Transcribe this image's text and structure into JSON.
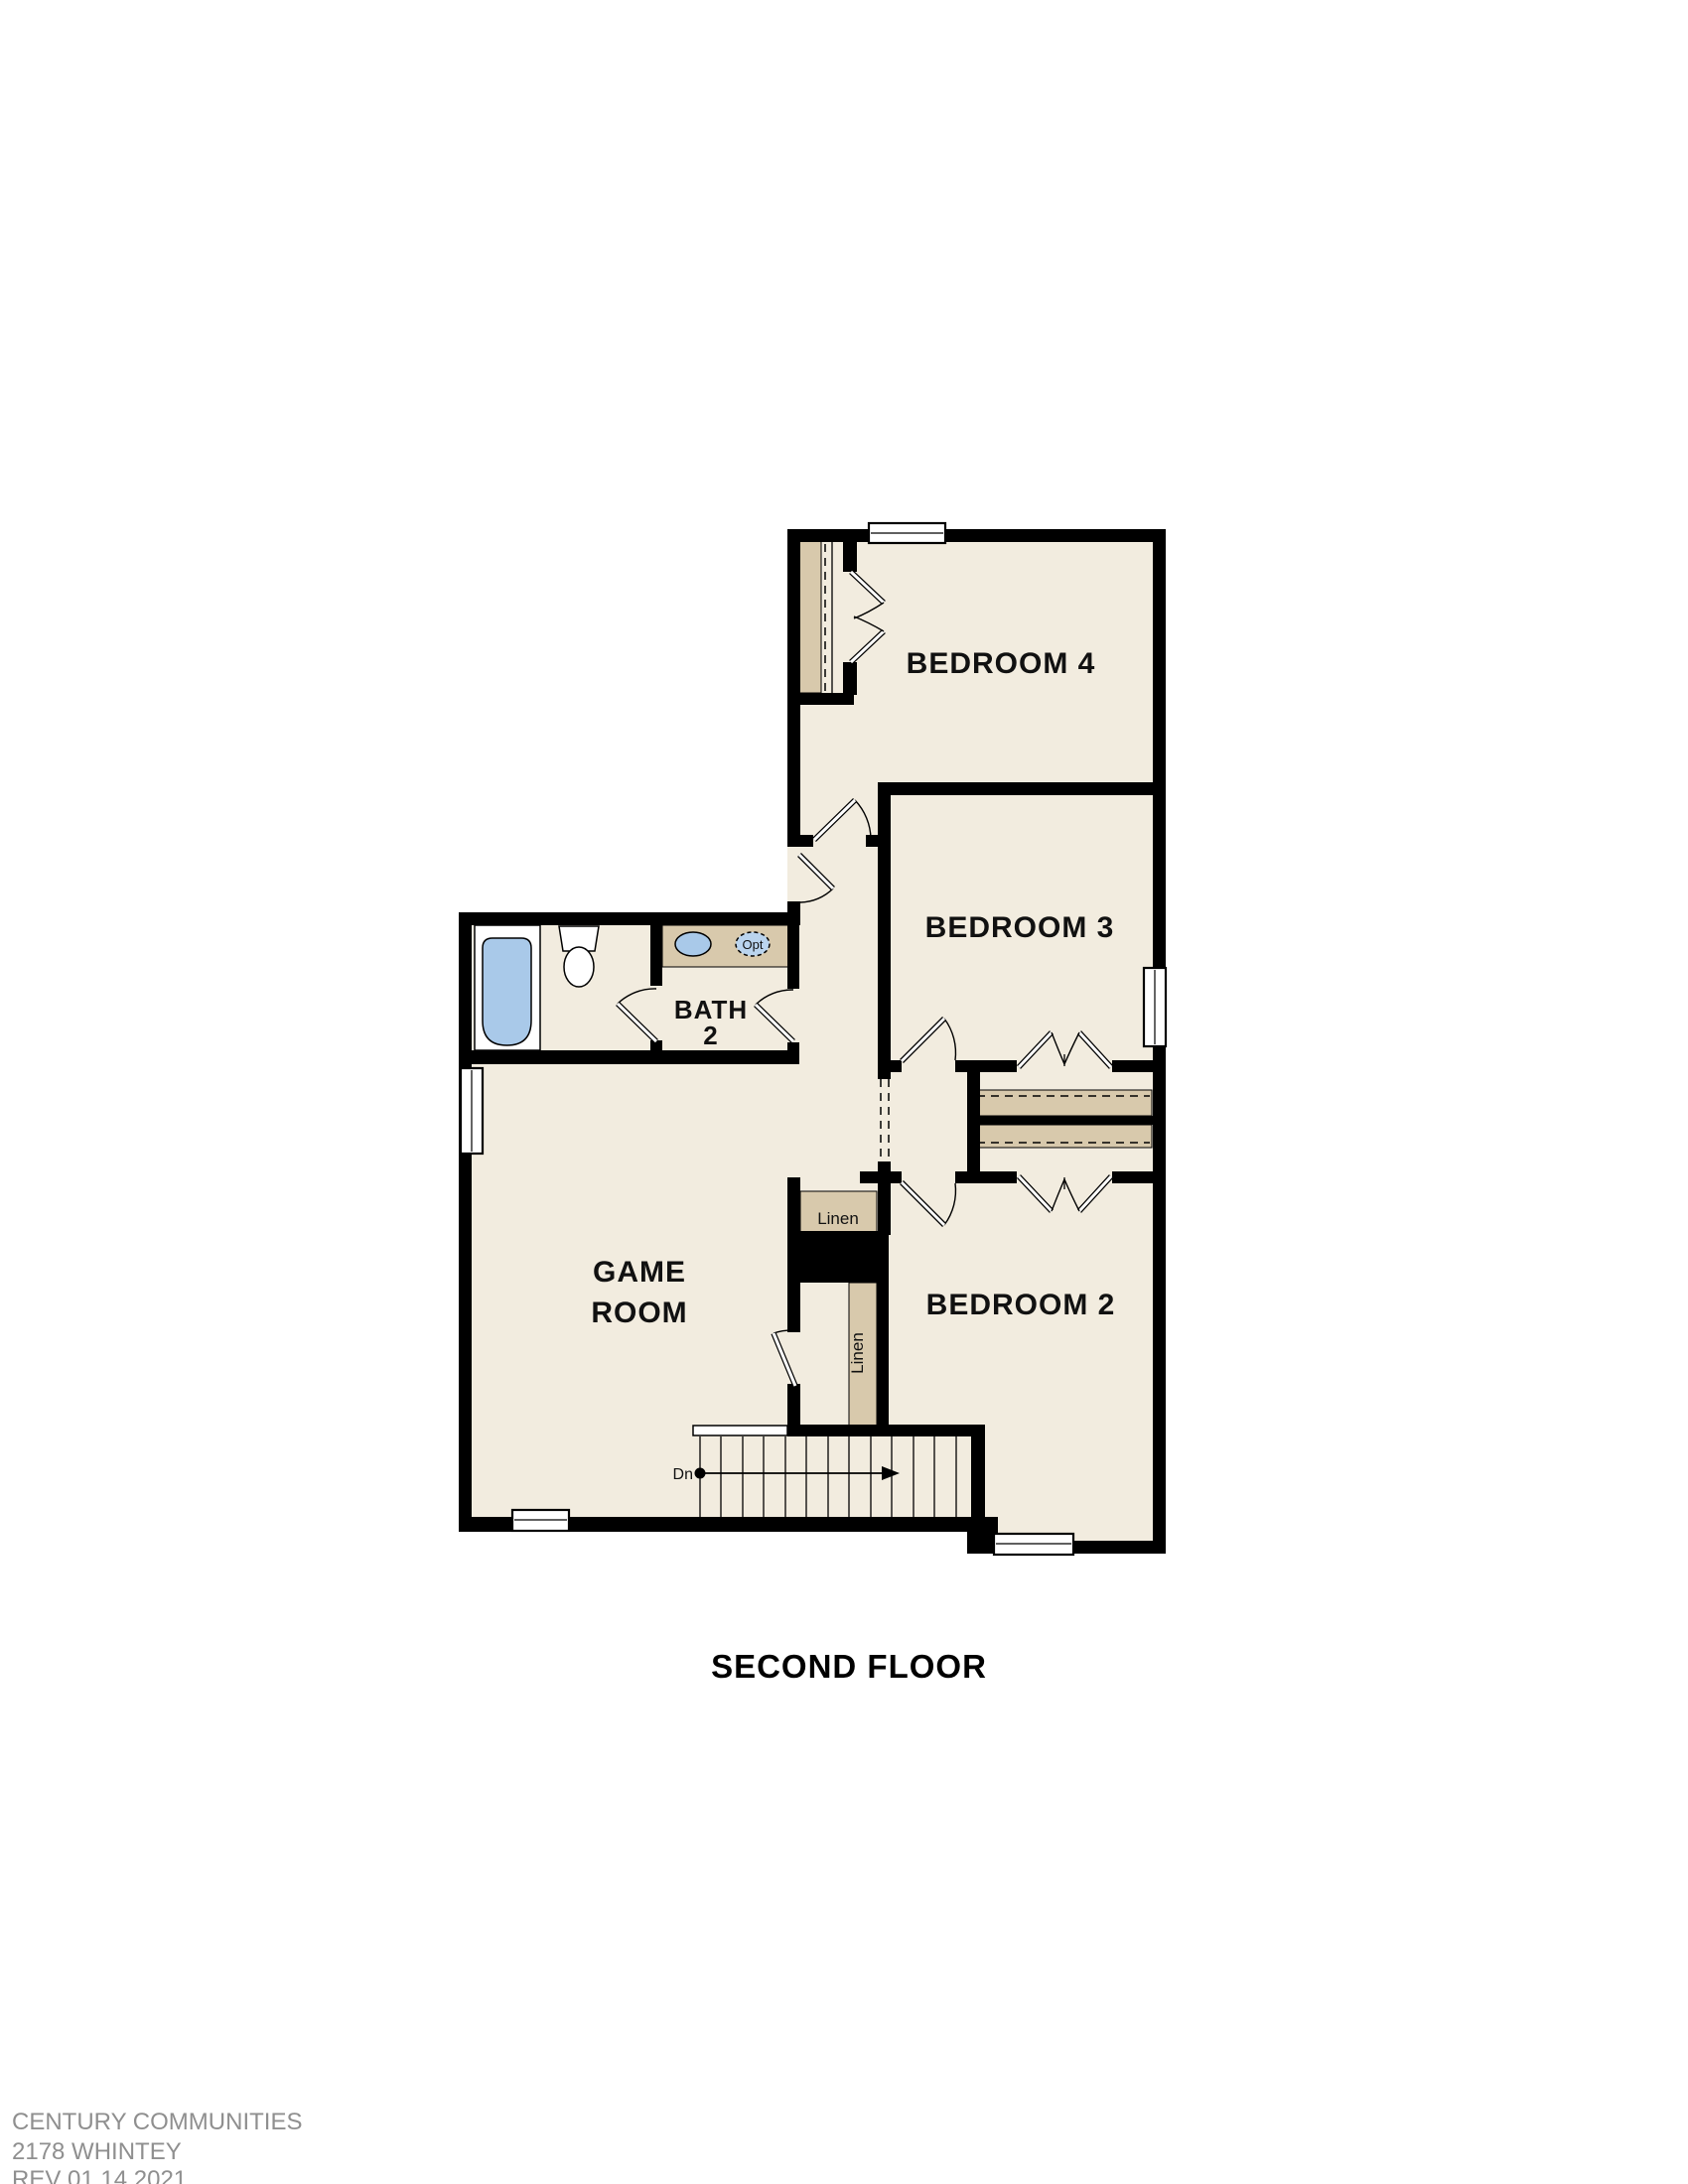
{
  "page": {
    "title": "SECOND FLOOR",
    "footer": {
      "line1": "CENTURY COMMUNITIES",
      "line2": "2178 WHINTEY",
      "line3": "REV 01.14.2021"
    }
  },
  "plan": {
    "rooms": {
      "bedroom4": {
        "label": "BEDROOM 4"
      },
      "bedroom3": {
        "label": "BEDROOM 3"
      },
      "bedroom2": {
        "label": "BEDROOM 2"
      },
      "bath2": {
        "line1": "BATH",
        "line2": "2"
      },
      "game_room": {
        "line1": "GAME",
        "line2": "ROOM"
      },
      "linen_hall": {
        "label": "Linen"
      },
      "linen_stair": {
        "label": "Linen"
      }
    },
    "annotations": {
      "stair_direction": "Dn",
      "optional_sink": "Opt"
    },
    "colors": {
      "floor": "#f2ecdf",
      "wall": "#000000",
      "casework": "#d8c9ac",
      "fixture_blue": "#a9c9e9",
      "fixture_blue_light": "#bad4ee",
      "label_text": "#111111",
      "footer_text": "#8f8f8f"
    }
  }
}
